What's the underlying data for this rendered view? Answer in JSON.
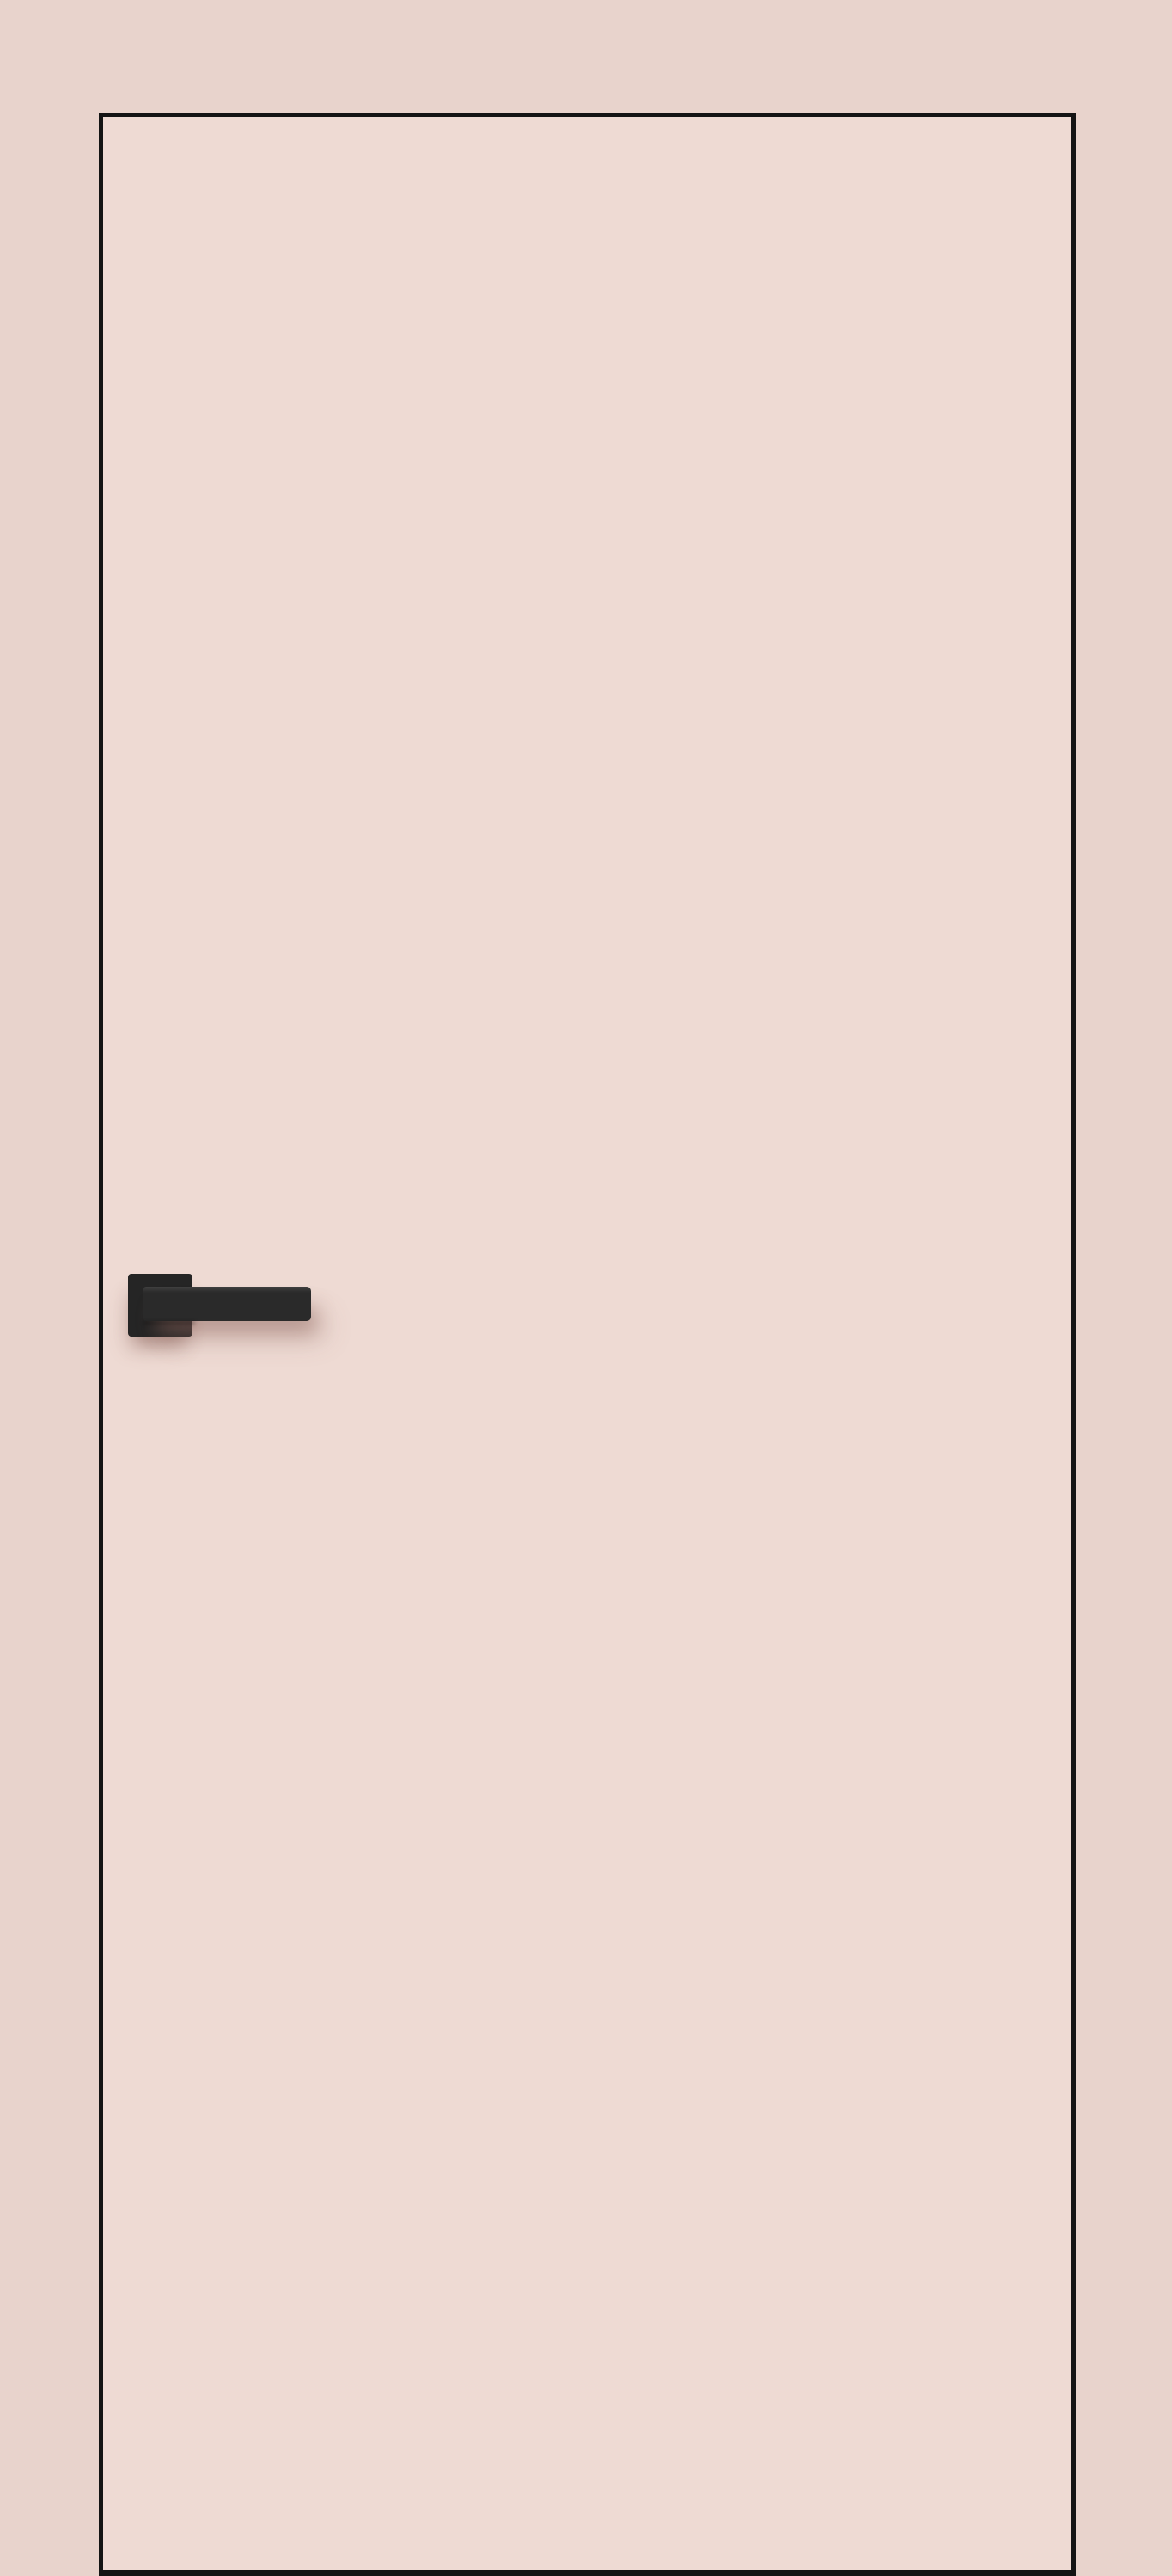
{
  "scene": {
    "alt": "Flush interior door leaf, front view, in pale blush pink with a thin black perimeter edge trim and a matte black square-rosette lever handle on the left side"
  },
  "colors": {
    "wall": "#e8d3cc",
    "door_face": "#eedad3",
    "door_edge": "#141414",
    "handle_rosette": "#252525",
    "handle_lever": "#2a2a2a"
  }
}
